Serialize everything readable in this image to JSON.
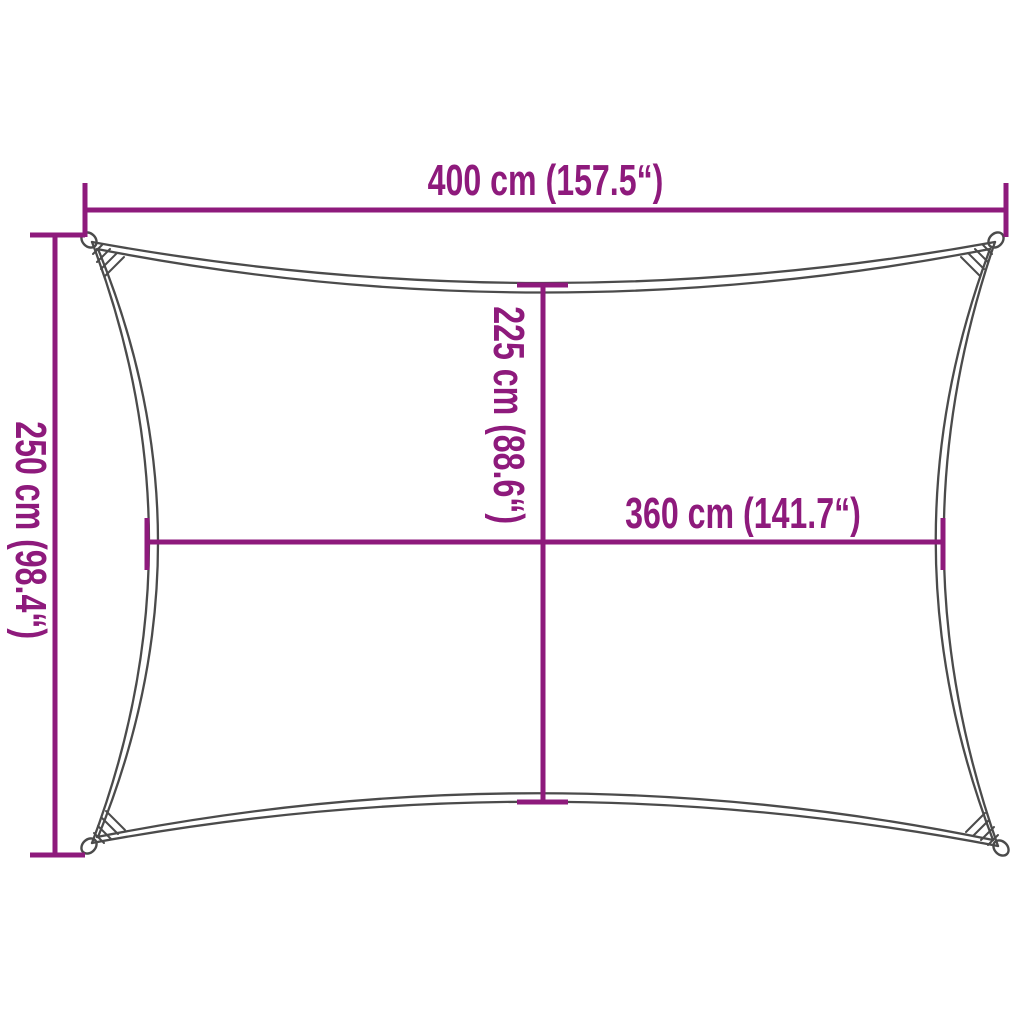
{
  "diagram": {
    "kind": "product-dimension-diagram",
    "subject": "rectangular shade sail with concave edges and corner eyelets",
    "colors": {
      "dimension_accent": "#8E1A7C",
      "sail_outline": "#4B4B4B",
      "background": "#FFFFFF"
    },
    "dimensions": {
      "top_width": {
        "label": "400 cm (157.5“)",
        "value_cm": 400,
        "value_in": 157.5
      },
      "left_height": {
        "label": "250 cm (98.4“)",
        "value_cm": 250,
        "value_in": 98.4
      },
      "inner_height": {
        "label": "225 cm (88.6“)",
        "value_cm": 225,
        "value_in": 88.6
      },
      "inner_width": {
        "label": "360 cm (141.7“)",
        "value_cm": 360,
        "value_in": 141.7
      }
    }
  }
}
